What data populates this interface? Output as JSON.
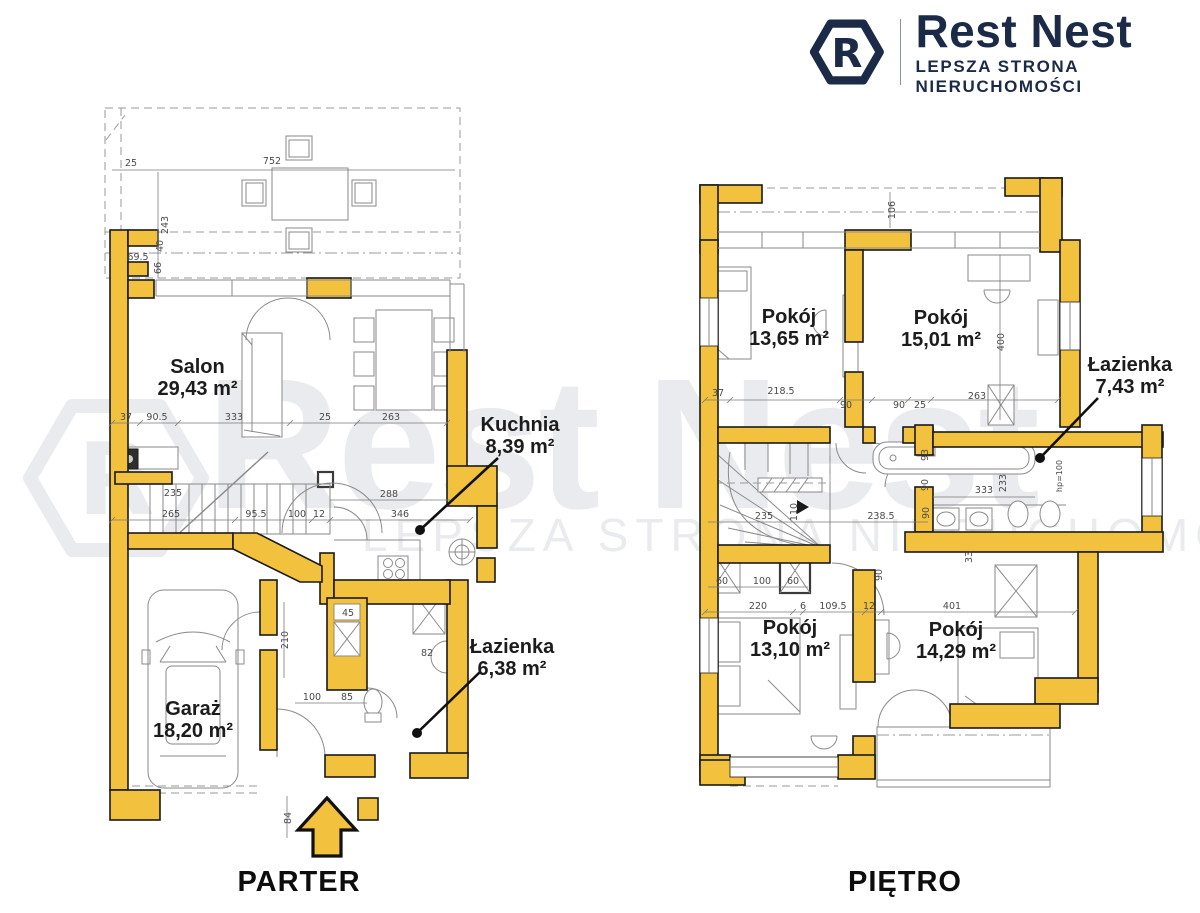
{
  "logo": {
    "brand": "Rest Nest",
    "tagline": "LEPSZA STRONA NIERUCHOMOŚCI",
    "icon_letter": "R"
  },
  "watermark": {
    "brand": "Rest Nest",
    "tagline": "LEPSZA STRONA NIERUCHOMOŚCI",
    "icon_letter": "R"
  },
  "colors": {
    "wall": "#F2C13D",
    "wall_outline": "#1A1A1A",
    "drawing_line": "#8A8A8A",
    "dim_text": "#4A4A4A",
    "label_text": "#1C1C1C",
    "brand_navy": "#1B2A47",
    "watermark_gray": "#E9EBEE"
  },
  "ground_floor": {
    "caption": "PARTER",
    "rooms": [
      {
        "name": "Salon",
        "area": "29,43 m²"
      },
      {
        "name": "Kuchnia",
        "area": "8,39 m²"
      },
      {
        "name": "Łazienka",
        "area": "6,38 m²"
      },
      {
        "name": "Garaż",
        "area": "18,20 m²"
      }
    ],
    "dims": [
      "25",
      "752",
      "243",
      "40",
      "69.5",
      "66",
      "37",
      "90.5",
      "333",
      "25",
      "263",
      "235",
      "265",
      "95.5",
      "100",
      "12",
      "288",
      "346",
      "210",
      "45",
      "82",
      "100",
      "85",
      "84"
    ]
  },
  "upper_floor": {
    "caption": "PIĘTRO",
    "rooms": [
      {
        "name": "Pokój",
        "area": "13,65 m²"
      },
      {
        "name": "Pokój",
        "area": "15,01 m²"
      },
      {
        "name": "Łazienka",
        "area": "7,43 m²"
      },
      {
        "name": "Pokój",
        "area": "13,10 m²"
      },
      {
        "name": "Pokój",
        "area": "14,29 m²"
      }
    ],
    "dims": [
      "106",
      "37",
      "218.5",
      "90",
      "90",
      "25",
      "263",
      "400",
      "93",
      "90",
      "333",
      "233",
      "hp=100",
      "110",
      "235",
      "238.5",
      "90",
      "60",
      "100",
      "60",
      "33",
      "90",
      "220",
      "6",
      "109.5",
      "12",
      "401"
    ]
  }
}
